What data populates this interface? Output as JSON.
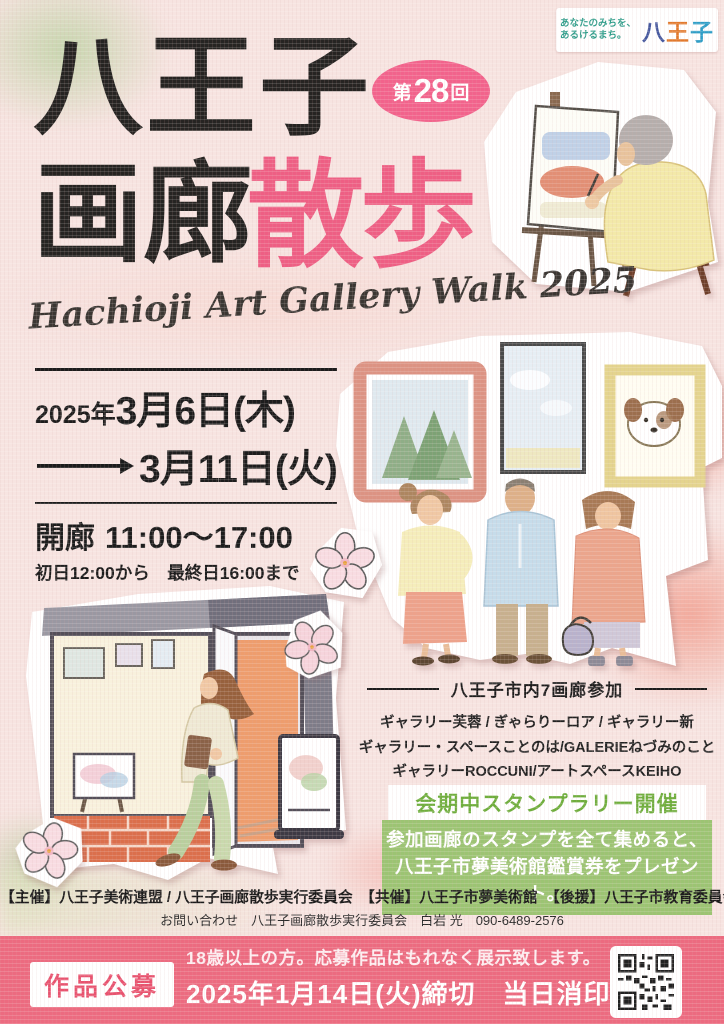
{
  "logo": {
    "tagline": "あなたのみちを、\nあるけるまち。",
    "city_chars": [
      "八",
      "王",
      "子"
    ]
  },
  "title": {
    "line1": "八王子",
    "line2_black": "画廊",
    "line2_pink": "散歩",
    "badge_pre": "第",
    "badge_num": "28",
    "badge_post": "回",
    "subtitle_en": "Hachioji Art Gallery Walk 2025"
  },
  "schedule": {
    "year": "2025年",
    "start_date": "3月6日(木)",
    "end_date": "3月11日(火)",
    "hours_label": "開廊",
    "hours": "11:00〜17:00",
    "hours_note": "初日12:00から　最終日16:00まで"
  },
  "galleries": {
    "header": "八王子市内7画廊参加",
    "lines": [
      "ギャラリー芙蓉 / ぎゃらりーロア / ギャラリー新",
      "ギャラリー・スペースことのは/GALERIEねづみのこと",
      "ギャラリーROCCUNI/アートスペースKEIHO"
    ]
  },
  "stamp_rally": {
    "title": "会期中スタンプラリー開催",
    "body_line1": "参加画廊のスタンプを全て集めると、",
    "body_line2": "八王子市夢美術館鑑賞券をプレゼント。"
  },
  "credits": {
    "organizers": "【主催】八王子美術連盟 / 八王子画廊散歩実行委員会　【共催】八王子市夢美術館　【後援】八王子市教育委員会",
    "contact": "お問い合わせ　八王子画廊散歩実行委員会　白岩 光　090-6489-2576"
  },
  "submission": {
    "label": "作品公募",
    "line1": "18歳以上の方。応募作品はもれなく展示致します。",
    "line2": "2025年1月14日(火)締切　当日消印有効"
  },
  "colors": {
    "accent_pink": "#ee5f84",
    "badge_pink": "#f2638c",
    "stamp_green": "#9cc473",
    "bar_pink": "#ec6b80"
  }
}
